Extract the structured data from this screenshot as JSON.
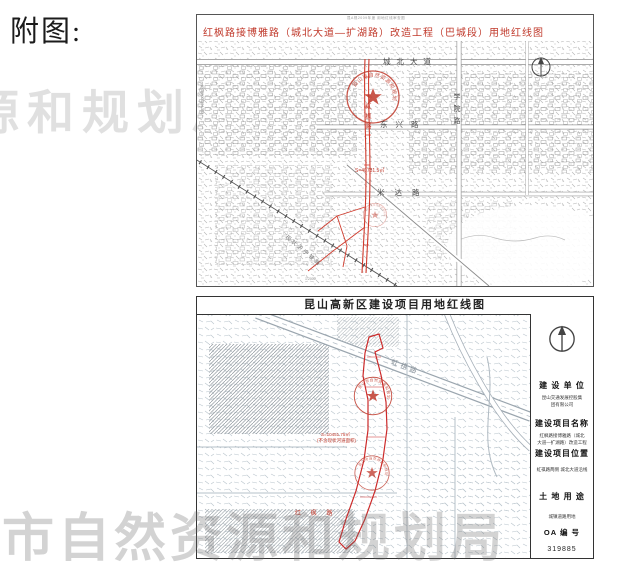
{
  "page": {
    "label": "附图:"
  },
  "watermarks": {
    "top": "源和规划局",
    "bottom": "市自然资源和规划局",
    "color": "#d9d9d9"
  },
  "seals": {
    "text": "昆山市自然资源和规划局",
    "color": "#c0392b"
  },
  "map1": {
    "micro_note": "昆A规2009年度 用地红线审查图",
    "title": "红枫路接博雅路（城北大道—扩湖路）改造工程（巴城段）用地红线图",
    "labels": {
      "road_top": "城北大道",
      "road_mid": "东兴路",
      "road_mid2": "米达路",
      "road_right_vertical": "学院路",
      "railway_diagonal": "现状沪宁铁路",
      "red_road_vertical": "红枫路",
      "area_text": "S=40731.5㎡",
      "side_micro": "苏S(2009)013号",
      "scale_note": "1:2000"
    }
  },
  "map2": {
    "title": "昆山高新区建设项目用地红线图",
    "labels": {
      "diag_road": "虹祺路",
      "area_line1": "S=10451.75㎡",
      "area_line2": "(不含现状河道面积)",
      "red_road_bottom": "红 枫 路"
    },
    "panel": {
      "unit_heading": "建 设 单 位",
      "unit_value_1": "昆山交通发展控股集",
      "unit_value_2": "团有限公司",
      "name_heading": "建设项目名称",
      "name_value_1": "红枫路接博雅路（城北",
      "name_value_2": "大道—扩湖路）改造工程",
      "loc_heading": "建设项目位置",
      "loc_value": "虹祺路两侧  城北大道沿线",
      "use_heading": "土 地 用 途",
      "use_value": "城镇道路用地",
      "oa_heading": "OA 编 号",
      "oa_value": "319885"
    }
  }
}
